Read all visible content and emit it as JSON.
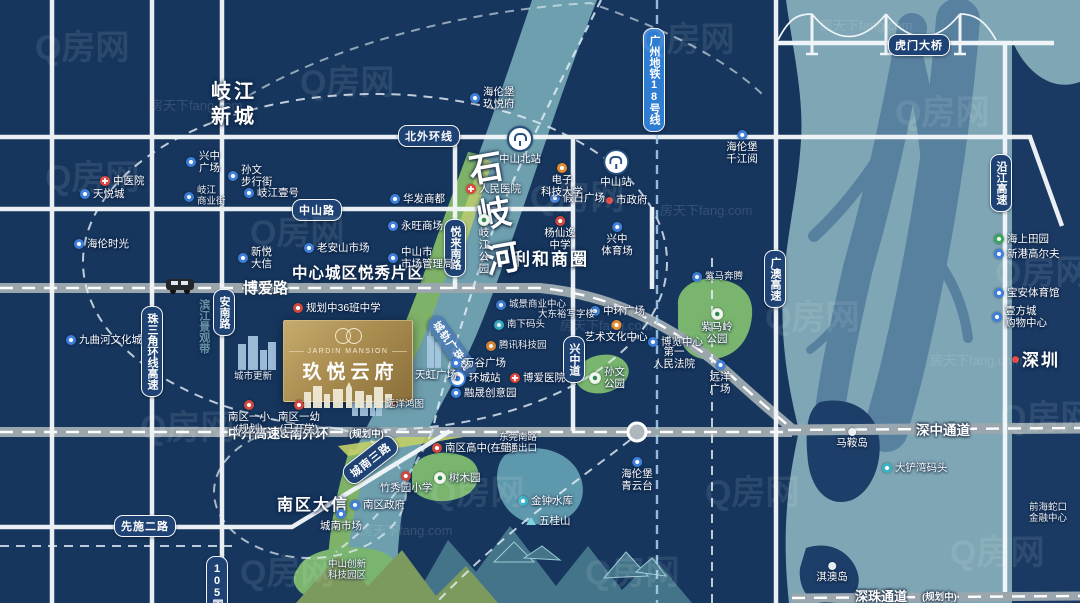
{
  "palette": {
    "background_navy": "#16365e",
    "sea_teal": "#7fa6b5",
    "river_teal": "#6e9fae",
    "park_green": "#79b56f",
    "gold_accent": "#b2975f",
    "road_white": "#f3f7fa",
    "highway_gray": "#9aa6ad",
    "pill_navy": "#1e4273",
    "metro_blue": "#2f7cd3",
    "poi_blue": "#3d7fd9",
    "poi_red": "#e2453e"
  },
  "watermark": {
    "primary": "Q房网",
    "secondary": "房天下fang.com"
  },
  "property_card": {
    "name_en": "JARDIN MANSION",
    "name_cn": "玖悦云府"
  },
  "road_pills": [
    {
      "id": "north-outer-ring-road",
      "label": "北外环线",
      "x": 398,
      "y": 125
    },
    {
      "id": "zhongshan-road",
      "label": "中山路",
      "x": 292,
      "y": 199
    },
    {
      "id": "pearl-delta-ring-expressway",
      "label": "珠三角环线高速",
      "x": 141,
      "y": 306,
      "v": 1
    },
    {
      "id": "annan-road",
      "label": "安南路",
      "x": 213,
      "y": 289,
      "v": 1
    },
    {
      "id": "yuelai-south-road",
      "label": "悦来南路",
      "x": 444,
      "y": 219,
      "v": 1
    },
    {
      "id": "xingzhong-avenue",
      "label": "兴中道",
      "x": 563,
      "y": 336,
      "v": 1
    },
    {
      "id": "xianshi-2nd-road",
      "label": "先施二路",
      "x": 114,
      "y": 515
    },
    {
      "id": "chengnan-3rd-road",
      "label": "城南三路",
      "x": 346,
      "y": 468,
      "rotate": -38
    },
    {
      "id": "guangao-expressway",
      "label": "广澳高速",
      "x": 764,
      "y": 250,
      "v": 1
    },
    {
      "id": "yanjiang-expressway",
      "label": "沿江高速",
      "x": 990,
      "y": 154,
      "v": 1
    },
    {
      "id": "humen-bridge",
      "label": "虎门大桥",
      "x": 888,
      "y": 34
    },
    {
      "id": "g105-national-road",
      "label": "105国道",
      "x": 206,
      "y": 556,
      "v": 1
    },
    {
      "id": "guangzhou-metro-line-18",
      "label": "广州地铁18号线",
      "x": 643,
      "y": 28,
      "v": 1,
      "variant": "blue"
    },
    {
      "id": "guangzhu-intercity-rail",
      "label": "城轨广珠线",
      "x": 432,
      "y": 308,
      "rotate": 55,
      "variant": "ghost"
    }
  ],
  "road_names": [
    {
      "id": "boai-road-name",
      "label": "博爱路",
      "x": 243,
      "y": 277,
      "size": 15
    },
    {
      "id": "zhongkai-expressway-name",
      "label": "中开高速&南外环",
      "x": 228,
      "y": 423,
      "size": 13
    },
    {
      "id": "zhongkai-planning-note",
      "label": "(规划中)",
      "x": 349,
      "y": 426,
      "size": 9.5
    },
    {
      "id": "shenzhong-corridor-name",
      "label": "深中通道",
      "x": 916,
      "y": 419,
      "size": 13.5
    },
    {
      "id": "shenzhu-corridor-name",
      "label": "深珠通道",
      "x": 855,
      "y": 586,
      "size": 13
    },
    {
      "id": "shenzhu-planning-note",
      "label": "(规划中)",
      "x": 922,
      "y": 589,
      "size": 9.5
    }
  ],
  "area_labels": [
    {
      "id": "qijiang-new-town",
      "lines": [
        "岐江",
        "新城"
      ],
      "x": 211,
      "y": 80,
      "size": 20,
      "ls": 3
    },
    {
      "id": "central-yuexiu-district",
      "lines": [
        "中心城区悦秀片区"
      ],
      "x": 292,
      "y": 264,
      "size": 15.5,
      "ls": 1
    },
    {
      "id": "lihe-business-circle",
      "lines": [
        "利和商圈"
      ],
      "x": 513,
      "y": 249,
      "size": 17,
      "ls": 2
    },
    {
      "id": "nanqu-daxin",
      "lines": [
        "南区大信"
      ],
      "x": 277,
      "y": 496,
      "size": 16,
      "ls": 2
    },
    {
      "id": "shenzhen",
      "lines": [
        "深圳"
      ],
      "x": 1022,
      "y": 350,
      "size": 17,
      "ls": 2
    },
    {
      "id": "shiqi-river",
      "lines": [
        "石岐河"
      ],
      "x": 470,
      "y": 150,
      "size": 34,
      "vertical": 1,
      "rotate": -10,
      "ls": 12
    },
    {
      "id": "binjiang-scenic-belt",
      "lines": [
        "滨江景观带"
      ],
      "x": 196,
      "y": 299,
      "size": 11,
      "vertical": 1,
      "opacity": 0.6,
      "color": "#9fd0d8"
    }
  ],
  "pois": [
    {
      "id": "zhongshan-north-station",
      "icon": "station",
      "x": 520,
      "y": 126,
      "layout": "below",
      "lines": [
        "中山北站"
      ]
    },
    {
      "id": "zhongshan-station",
      "icon": "station",
      "x": 616,
      "y": 149,
      "layout": "below",
      "lines": [
        "中山站"
      ]
    },
    {
      "id": "huancheng-station",
      "icon": "metro",
      "x": 449,
      "y": 370,
      "layout": "right",
      "lines": [
        "环城站"
      ]
    },
    {
      "id": "traditional-chinese-medicine-hospital",
      "icon": "hospital",
      "x": 100,
      "y": 175,
      "layout": "right",
      "lines": [
        "中医院"
      ]
    },
    {
      "id": "peoples-hospital",
      "icon": "hospital",
      "x": 466,
      "y": 183,
      "layout": "right",
      "lines": [
        "人民医院"
      ]
    },
    {
      "id": "boai-hospital",
      "icon": "hospital",
      "x": 510,
      "y": 372,
      "layout": "right",
      "lines": [
        "博爱医院"
      ]
    },
    {
      "id": "tianyue-city",
      "icon": "shop",
      "x": 80,
      "y": 188,
      "layout": "right",
      "lines": [
        "天悦城"
      ]
    },
    {
      "id": "helen-time",
      "icon": "shop",
      "x": 74,
      "y": 238,
      "layout": "right",
      "lines": [
        "海伦时光"
      ]
    },
    {
      "id": "xingzhong-plaza",
      "icon": "shop",
      "x": 186,
      "y": 150,
      "layout": "right",
      "lines": [
        "兴中",
        "广场"
      ]
    },
    {
      "id": "sunwen-pedestrian-street",
      "icon": "shop",
      "x": 228,
      "y": 164,
      "layout": "right",
      "lines": [
        "孙文",
        "步行街"
      ]
    },
    {
      "id": "qijiang-commercial-street",
      "icon": "shop",
      "x": 184,
      "y": 186,
      "layout": "right",
      "lines": [
        "岐江",
        "商业街"
      ],
      "small": 1
    },
    {
      "id": "qijiang-no1",
      "icon": "shop",
      "x": 244,
      "y": 187,
      "layout": "right",
      "lines": [
        "岐江壹号"
      ]
    },
    {
      "id": "helenberg-jiuyuefu",
      "icon": "shop",
      "x": 470,
      "y": 86,
      "layout": "right",
      "lines": [
        "海伦堡",
        "玖悦府"
      ]
    },
    {
      "id": "huafa-shangdu",
      "icon": "shop",
      "x": 390,
      "y": 193,
      "layout": "right",
      "lines": [
        "华发商都"
      ]
    },
    {
      "id": "aeon-mall",
      "icon": "shop",
      "x": 388,
      "y": 220,
      "layout": "right",
      "lines": [
        "永旺商场"
      ]
    },
    {
      "id": "zhongshan-market-admin",
      "icon": "shop",
      "x": 388,
      "y": 246,
      "layout": "right",
      "lines": [
        "中山市",
        "市场管理局"
      ]
    },
    {
      "id": "holiday-plaza",
      "icon": "shop",
      "x": 550,
      "y": 192,
      "layout": "right",
      "lines": [
        "假日广场"
      ]
    },
    {
      "id": "city-government",
      "icon": "dot-red",
      "x": 606,
      "y": 194,
      "layout": "right",
      "lines": [
        "市政府"
      ]
    },
    {
      "id": "uestc-zhongshan",
      "icon": "orange",
      "x": 562,
      "y": 163,
      "layout": "below",
      "lines": [
        "电子",
        "科技大学"
      ]
    },
    {
      "id": "yangxianyi-middle-school",
      "icon": "school",
      "x": 560,
      "y": 216,
      "layout": "below",
      "lines": [
        "杨仙逸",
        "中学"
      ]
    },
    {
      "id": "laoanshan-market",
      "icon": "shop",
      "x": 304,
      "y": 242,
      "layout": "right",
      "lines": [
        "老安山市场"
      ]
    },
    {
      "id": "xinyue-daxin",
      "icon": "shop",
      "x": 238,
      "y": 246,
      "layout": "right",
      "lines": [
        "新悦",
        "大信"
      ]
    },
    {
      "id": "xingzhong-stadium",
      "icon": "shop",
      "x": 617,
      "y": 222,
      "layout": "below",
      "lines": [
        "兴中",
        "体育场"
      ]
    },
    {
      "id": "ziman-benteng",
      "icon": "shop",
      "x": 692,
      "y": 272,
      "layout": "right",
      "lines": [
        "紫马奔腾"
      ],
      "small": 1
    },
    {
      "id": "jiuquhe-culture-city",
      "icon": "shop",
      "x": 66,
      "y": 334,
      "layout": "right",
      "lines": [
        "九曲河文化城"
      ]
    },
    {
      "id": "planned-36-class-school",
      "icon": "school",
      "x": 293,
      "y": 302,
      "layout": "right",
      "lines": [
        "规划中36班中学"
      ]
    },
    {
      "id": "urban-renewal",
      "icon": "none",
      "x": 253,
      "y": 372,
      "layout": "below",
      "lines": [
        "城市更新"
      ],
      "small": 1
    },
    {
      "id": "zhonghuan-plaza",
      "icon": "shop",
      "x": 590,
      "y": 305,
      "layout": "right",
      "lines": [
        "中环广场"
      ]
    },
    {
      "id": "art-culture-center",
      "icon": "orange",
      "x": 616,
      "y": 320,
      "layout": "below",
      "lines": [
        "艺术文化中心"
      ]
    },
    {
      "id": "expo-center",
      "icon": "shop",
      "x": 648,
      "y": 336,
      "layout": "right",
      "lines": [
        "博览中心"
      ]
    },
    {
      "id": "first-peoples-court",
      "icon": "none",
      "x": 674,
      "y": 346,
      "layout": "below",
      "lines": [
        "第一",
        "人民法院"
      ]
    },
    {
      "id": "chengjing-business-center",
      "icon": "shop",
      "x": 496,
      "y": 300,
      "layout": "right",
      "lines": [
        "城景商业中心"
      ],
      "small": 1
    },
    {
      "id": "dadongyu-office",
      "icon": "none",
      "x": 538,
      "y": 310,
      "layout": "right",
      "lines": [
        "大东裕写字楼"
      ],
      "small": 1
    },
    {
      "id": "nanxia-wharf",
      "icon": "teal",
      "x": 494,
      "y": 320,
      "layout": "right",
      "lines": [
        "南下码头"
      ],
      "small": 1
    },
    {
      "id": "tencent-tech-park",
      "icon": "orange",
      "x": 486,
      "y": 341,
      "layout": "right",
      "lines": [
        "腾讯科技园"
      ],
      "small": 1
    },
    {
      "id": "wangu-plaza",
      "icon": "shop",
      "x": 451,
      "y": 357,
      "layout": "right",
      "lines": [
        "万谷广场"
      ]
    },
    {
      "id": "rongsheng-creative-park",
      "icon": "shop",
      "x": 451,
      "y": 387,
      "layout": "right",
      "lines": [
        "融晟创意园"
      ]
    },
    {
      "id": "tianhong-plaza",
      "icon": "none",
      "x": 436,
      "y": 369,
      "layout": "below",
      "lines": [
        "天虹广场"
      ]
    },
    {
      "id": "yuanyang-plaza",
      "icon": "shop",
      "x": 720,
      "y": 360,
      "layout": "below",
      "lines": [
        "远洋",
        "广场"
      ]
    },
    {
      "id": "yuanyang-hongtu",
      "icon": "none",
      "x": 386,
      "y": 400,
      "layout": "right",
      "lines": [
        "远洋鸿图"
      ],
      "small": 1
    },
    {
      "id": "zimaling-park",
      "icon": "park-white",
      "x": 717,
      "y": 308,
      "layout": "below",
      "lines": [
        "紫马岭",
        "公园"
      ]
    },
    {
      "id": "sunwen-park",
      "icon": "park-white",
      "x": 589,
      "y": 366,
      "layout": "right",
      "lines": [
        "孙文",
        "公园"
      ]
    },
    {
      "id": "qijiang-park",
      "icon": "park-white",
      "x": 484,
      "y": 214,
      "layout": "below",
      "lines": [
        "岐",
        "江",
        "公",
        "园"
      ]
    },
    {
      "id": "shumuyuan-arboretum",
      "icon": "park-white",
      "x": 434,
      "y": 472,
      "layout": "right",
      "lines": [
        "树木园"
      ]
    },
    {
      "id": "jinzhong-reservoir",
      "icon": "teal",
      "x": 518,
      "y": 495,
      "layout": "right",
      "lines": [
        "金钟水库"
      ]
    },
    {
      "id": "wugui-mountain",
      "icon": "mountain",
      "x": 526,
      "y": 515,
      "layout": "right",
      "lines": [
        "五桂山"
      ]
    },
    {
      "id": "nanqu-first-primary",
      "icon": "school",
      "x": 249,
      "y": 400,
      "layout": "below",
      "lines": [
        "南区一小",
        "(规划)"
      ]
    },
    {
      "id": "nanqu-first-kindergarten",
      "icon": "school",
      "x": 299,
      "y": 400,
      "layout": "below",
      "lines": [
        "南区一幼",
        "(已开学)"
      ]
    },
    {
      "id": "nanqu-high-school",
      "icon": "school",
      "x": 432,
      "y": 442,
      "layout": "right",
      "lines": [
        "南区高中(在建)"
      ]
    },
    {
      "id": "zhuxiuyuan-primary",
      "icon": "school",
      "x": 406,
      "y": 471,
      "layout": "below",
      "lines": [
        "竹秀园小学"
      ]
    },
    {
      "id": "nanqu-government",
      "icon": "shop",
      "x": 350,
      "y": 499,
      "layout": "right",
      "lines": [
        "南区政府"
      ]
    },
    {
      "id": "chengnan-market",
      "icon": "shop",
      "x": 341,
      "y": 509,
      "layout": "below",
      "lines": [
        "城南市场"
      ]
    },
    {
      "id": "dongguan-south-exit",
      "icon": "none",
      "x": 518,
      "y": 433,
      "layout": "below",
      "lines": [
        "东莞南路",
        "互通出口"
      ],
      "small": 1
    },
    {
      "id": "zhongshan-innovation-tech-park",
      "icon": "none",
      "x": 347,
      "y": 560,
      "layout": "below",
      "lines": [
        "中山创新",
        "科技园区"
      ],
      "small": 1
    },
    {
      "id": "helenberg-qianjiangyue",
      "icon": "shop",
      "x": 742,
      "y": 130,
      "layout": "below",
      "lines": [
        "海伦堡",
        "千江阅"
      ]
    },
    {
      "id": "helenberg-qingyuntai",
      "icon": "shop",
      "x": 637,
      "y": 457,
      "layout": "below",
      "lines": [
        "海伦堡",
        "青云台"
      ]
    },
    {
      "id": "seaside-paradise",
      "icon": "park",
      "x": 994,
      "y": 233,
      "layout": "right",
      "lines": [
        "海上田园"
      ]
    },
    {
      "id": "xingang-golf",
      "icon": "shop",
      "x": 994,
      "y": 248,
      "layout": "right",
      "lines": [
        "新港高尔夫"
      ]
    },
    {
      "id": "baoan-stadium",
      "icon": "shop",
      "x": 994,
      "y": 287,
      "layout": "right",
      "lines": [
        "宝安体育馆"
      ]
    },
    {
      "id": "yifangcheng-mall",
      "icon": "shop",
      "x": 992,
      "y": 305,
      "layout": "right",
      "lines": [
        "壹方城",
        "购物中心"
      ]
    },
    {
      "id": "dachanwan-terminal",
      "icon": "teal",
      "x": 882,
      "y": 462,
      "layout": "right",
      "lines": [
        "大铲湾码头"
      ]
    },
    {
      "id": "maan-island",
      "icon": "island",
      "x": 852,
      "y": 428,
      "layout": "below",
      "lines": [
        "马鞍岛"
      ]
    },
    {
      "id": "qiao-island",
      "icon": "island",
      "x": 832,
      "y": 562,
      "layout": "below",
      "lines": [
        "淇澳岛"
      ]
    },
    {
      "id": "qianhai-shekou-center",
      "icon": "none",
      "x": 1048,
      "y": 503,
      "layout": "below",
      "lines": [
        "前海蛇口",
        "金融中心"
      ],
      "small": 1
    },
    {
      "id": "shenzhen-dot",
      "icon": "dot-red",
      "x": 1012,
      "y": 356,
      "layout": "right",
      "lines": []
    }
  ],
  "watermarks": [
    {
      "x": 35,
      "y": 20,
      "s": 34
    },
    {
      "x": 300,
      "y": 55,
      "s": 34
    },
    {
      "x": 640,
      "y": 12,
      "s": 34
    },
    {
      "x": 895,
      "y": 85,
      "s": 34
    },
    {
      "x": 45,
      "y": 150,
      "s": 34
    },
    {
      "x": 250,
      "y": 205,
      "s": 34
    },
    {
      "x": 530,
      "y": 170,
      "s": 34
    },
    {
      "x": 765,
      "y": 290,
      "s": 34
    },
    {
      "x": 995,
      "y": 245,
      "s": 34
    },
    {
      "x": 140,
      "y": 400,
      "s": 34
    },
    {
      "x": 430,
      "y": 465,
      "s": 34
    },
    {
      "x": 705,
      "y": 465,
      "s": 34
    },
    {
      "x": 950,
      "y": 525,
      "s": 34
    },
    {
      "x": 240,
      "y": 545,
      "s": 34
    },
    {
      "x": 585,
      "y": 545,
      "s": 34
    },
    {
      "x": 1000,
      "y": 390,
      "s": 34
    },
    {
      "x": 150,
      "y": 95,
      "s": 13,
      "t": "f"
    },
    {
      "x": 560,
      "y": 315,
      "s": 13,
      "t": "f"
    },
    {
      "x": 820,
      "y": 15,
      "s": 13,
      "t": "f"
    },
    {
      "x": 360,
      "y": 520,
      "s": 13,
      "t": "f"
    },
    {
      "x": 930,
      "y": 350,
      "s": 13,
      "t": "f"
    },
    {
      "x": 660,
      "y": 200,
      "s": 13,
      "t": "f"
    }
  ]
}
